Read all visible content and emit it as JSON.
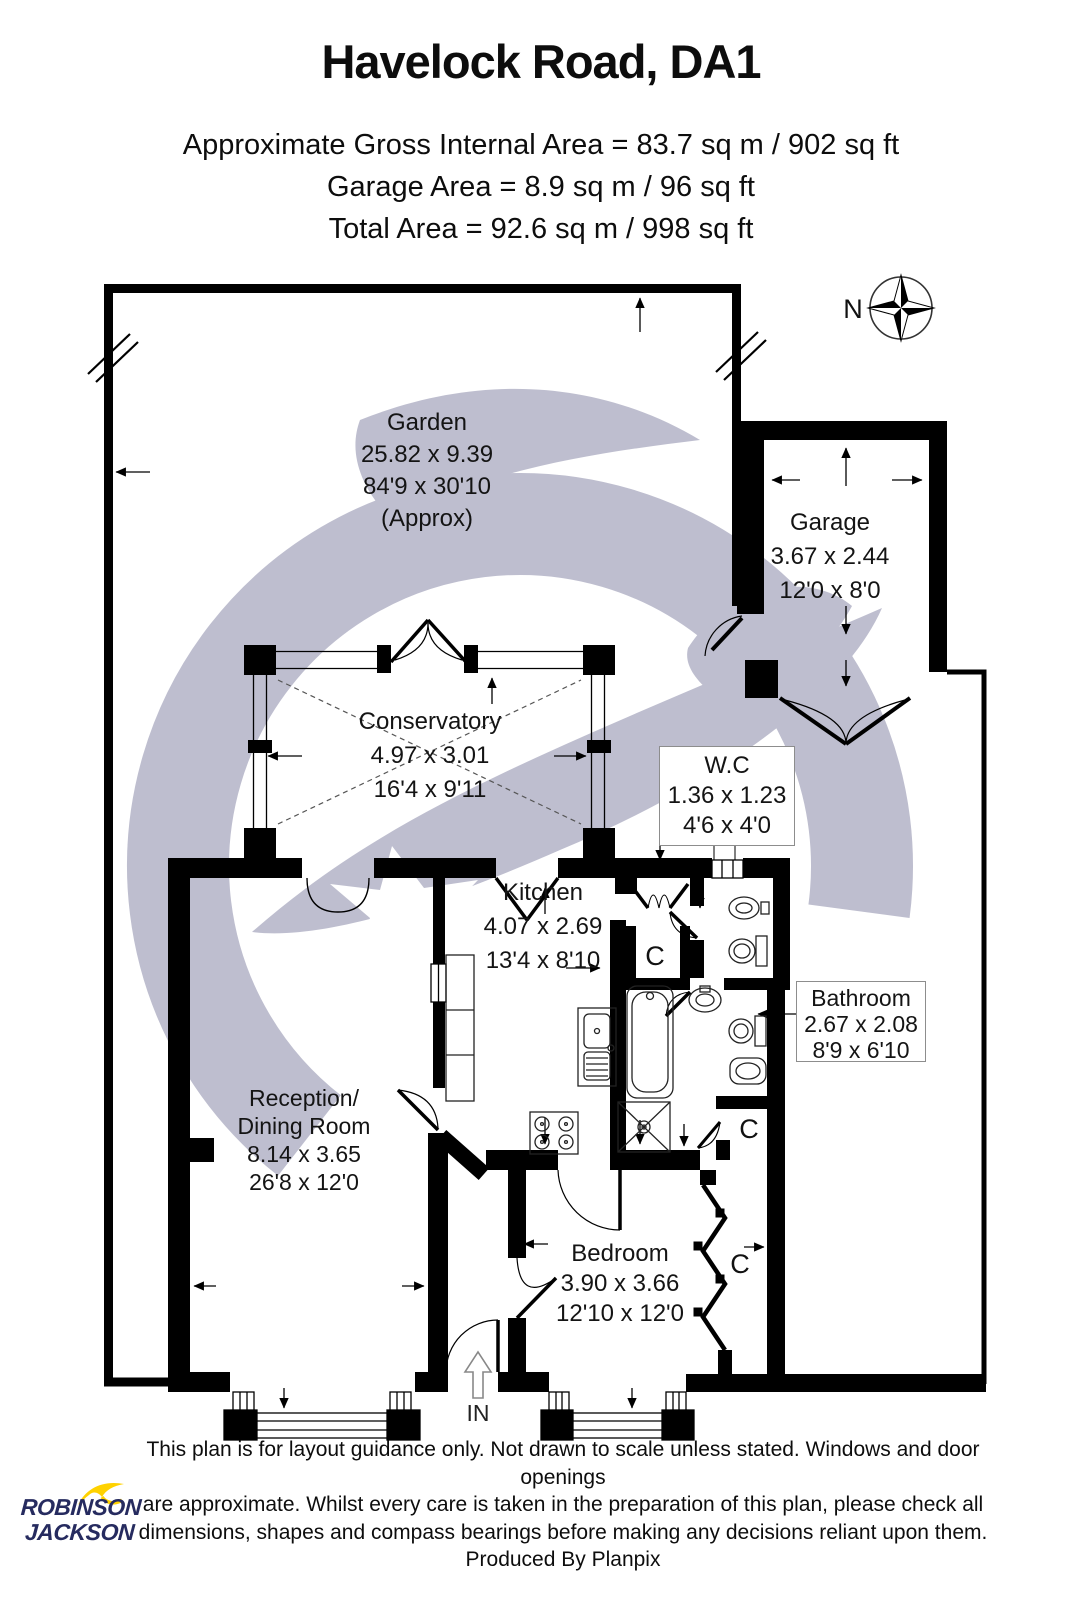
{
  "header": {
    "title": "Havelock Road, DA1",
    "area_line_1": "Approximate Gross Internal Area = 83.7 sq m / 902 sq ft",
    "area_line_2": "Garage Area = 8.9 sq m / 96 sq ft",
    "area_line_3": "Total Area = 92.6 sq m / 998 sq ft"
  },
  "compass": {
    "north_label": "N"
  },
  "plan": {
    "rooms": {
      "garden": {
        "name": "Garden",
        "dims_metric": "25.82 x 9.39",
        "dims_imperial": "84'9 x 30'10",
        "note": "(Approx)"
      },
      "garage": {
        "name": "Garage",
        "dims_metric": "3.67 x 2.44",
        "dims_imperial": "12'0 x 8'0"
      },
      "conservatory": {
        "name": "Conservatory",
        "dims_metric": "4.97 x 3.01",
        "dims_imperial": "16'4 x 9'11"
      },
      "wc": {
        "name": "W.C",
        "dims_metric": "1.36 x 1.23",
        "dims_imperial": "4'6 x 4'0"
      },
      "kitchen": {
        "name": "Kitchen",
        "dims_metric": "4.07 x 2.69",
        "dims_imperial": "13'4 x 8'10"
      },
      "bathroom": {
        "name": "Bathroom",
        "dims_metric": "2.67 x 2.08",
        "dims_imperial": "8'9 x 6'10"
      },
      "reception": {
        "name_line_1": "Reception/",
        "name_line_2": "Dining Room",
        "dims_metric": "8.14 x 3.65",
        "dims_imperial": "26'8 x 12'0"
      },
      "bedroom": {
        "name": "Bedroom",
        "dims_metric": "3.90 x 3.66",
        "dims_imperial": "12'10 x 12'0"
      }
    },
    "markers": {
      "cupboard": "C",
      "entrance": "IN"
    }
  },
  "footer": {
    "logo_line_1": "ROBINSON",
    "logo_line_2": "JACKSON",
    "disclaimer_line_1": "This plan is for layout guidance only. Not drawn to scale unless stated. Windows and door openings",
    "disclaimer_line_2": "are approximate. Whilst every care is taken in the preparation of this plan, please check all",
    "disclaimer_line_3": "dimensions, shapes and compass bearings before making any decisions reliant upon them.",
    "disclaimer_line_4": "Produced By Planpix"
  },
  "colors": {
    "wall": "#000000",
    "watermark": "#b9b9cb",
    "logo_navy": "#262b5f",
    "logo_yellow": "#ffd200",
    "text": "#111111"
  }
}
